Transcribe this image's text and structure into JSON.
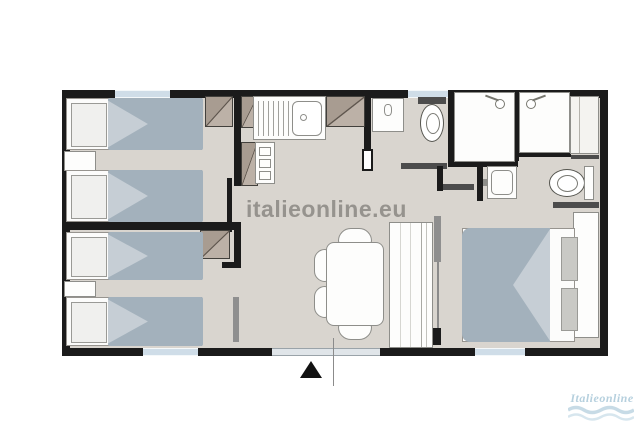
{
  "watermark": {
    "text": "italieonline.eu",
    "color": "#96938e"
  },
  "brand": {
    "name": "Italieonline",
    "color": "#b6d0de"
  },
  "palette": {
    "wall": "#1b1b1b",
    "floor": "#d9d5cf",
    "bed_cover": "#a3b1bc",
    "bed_fold": "#c6ced5",
    "cabinet_wood": "#a89c91",
    "window_glass": "#cfdde8",
    "entrance_door": "#e0e5e9",
    "fixture_white": "#fdfdfc",
    "slide_door_gray": "#8f8f8f"
  },
  "icons": [
    "single-bed-icon",
    "double-bed-icon",
    "pillow-icon",
    "wardrobe-icon",
    "nightstand-icon",
    "kitchen-sink-icon",
    "stove-icon",
    "washbasin-icon",
    "toilet-icon",
    "shower-icon",
    "dining-table-icon",
    "chair-icon",
    "sofa-icon",
    "window",
    "entrance-door",
    "entrance-arrow-icon",
    "wave-icon"
  ]
}
